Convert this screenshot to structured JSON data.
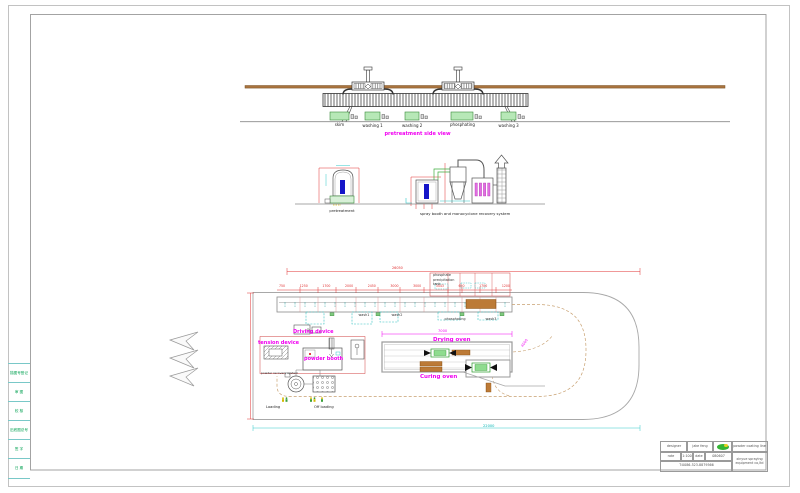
{
  "colors": {
    "accent_magenta": "#f000f0",
    "dim_red": "#e03030",
    "dim_cyan": "#00b4b4",
    "tank_green": "#b7e8b7",
    "beam_brown": "#a9743f",
    "workpiece_blue": "#1515c8"
  },
  "top_view": {
    "title": "pretreatment side view",
    "tanks": [
      "skim",
      "washing 1",
      "washing 2",
      "phosphating",
      "washing 3"
    ]
  },
  "sections": {
    "pretreatment": "pretreatment",
    "spray": "spray booth and monocyclone recovery system"
  },
  "plan": {
    "phosphate": [
      "phosphate",
      "precipitation",
      "tank"
    ],
    "tanks": {
      "wash1": "wash1",
      "wash2": "wash2",
      "phosphating": "phosphating",
      "wash3": "wash3"
    },
    "labels": {
      "driving": "Driving device",
      "tension": "tension device",
      "booth": "powder booth",
      "recovery": "powder recovery system",
      "drying": "Drying oven",
      "curing": "Curing oven",
      "loading": "Loading",
      "offloading": "Off loading"
    },
    "dims": {
      "total_top": "26050",
      "total_bottom": "22000",
      "oven": "7000",
      "curve": "4000",
      "top_row": [
        "750",
        "1250",
        "1700",
        "2000",
        "2450",
        "3000",
        "3000",
        "3443",
        "650",
        "1700",
        "1200"
      ]
    }
  },
  "title_block": {
    "designer_label": "designer",
    "designer_value": "jake feng",
    "rate_label": "rate",
    "rate_value": "1:100",
    "date_label": "date",
    "date_value": "080607",
    "phone": "T:0086-523-8879566",
    "product": "powder coating line",
    "company": "xinyue spraying equipment co,ltd"
  },
  "side_strip": {
    "items": [
      "描图号登记",
      "审 图",
      "校 核",
      "旧底图总号",
      "签 字",
      "日 期"
    ]
  }
}
